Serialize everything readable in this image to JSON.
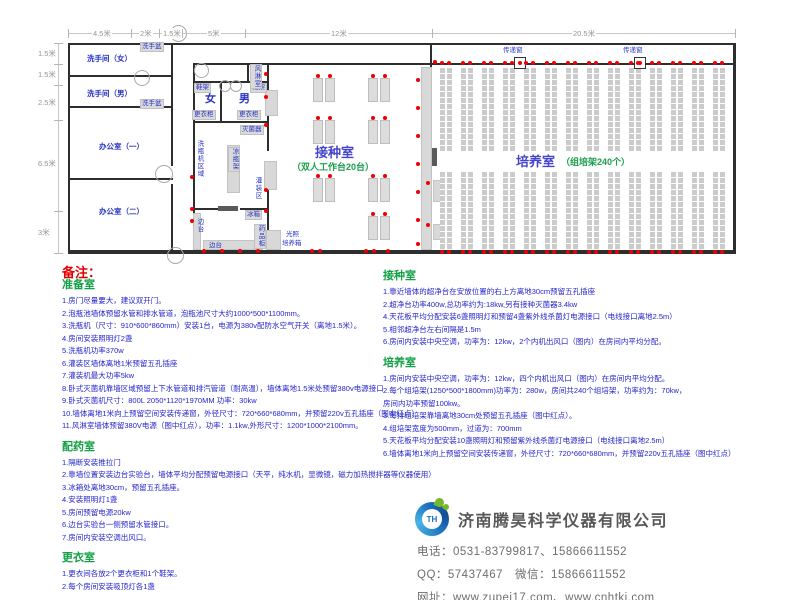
{
  "plan": {
    "dims_top": {
      "line_y": 33,
      "x1": 68,
      "x2": 735,
      "ticks": [
        68,
        131,
        159,
        182,
        245,
        432,
        735
      ],
      "labels": [
        {
          "t": "4.5米",
          "x": 92
        },
        {
          "t": "2米",
          "x": 139
        },
        {
          "t": "1.5米",
          "x": 162
        },
        {
          "t": "5米",
          "x": 207
        },
        {
          "t": "12米",
          "x": 330
        },
        {
          "t": "20.5米",
          "x": 572
        }
      ]
    },
    "dims_left": {
      "line_x": 58,
      "y1": 43,
      "y2": 253,
      "ticks": [
        43,
        64,
        85,
        120,
        211,
        253
      ],
      "labels": [
        {
          "t": "1.5米",
          "y": 48
        },
        {
          "t": "1.5米",
          "y": 69
        },
        {
          "t": "2.5米",
          "y": 97
        },
        {
          "t": "6.5米",
          "y": 158
        },
        {
          "t": "3米",
          "y": 227
        }
      ]
    },
    "walls": [
      [
        68,
        43,
        667,
        2
      ],
      [
        68,
        250,
        667,
        4
      ],
      [
        68,
        43,
        2,
        211
      ],
      [
        733,
        43,
        3,
        211
      ],
      [
        171,
        43,
        2,
        123
      ],
      [
        171,
        184,
        2,
        66
      ],
      [
        68,
        75,
        105,
        2
      ],
      [
        68,
        106,
        105,
        2
      ],
      [
        68,
        178,
        105,
        2
      ],
      [
        193,
        63,
        542,
        2
      ],
      [
        193,
        63,
        2,
        187
      ],
      [
        193,
        81,
        76,
        2
      ],
      [
        220,
        81,
        2,
        42
      ],
      [
        193,
        121,
        76,
        2
      ],
      [
        247,
        63,
        2,
        20
      ],
      [
        267,
        63,
        2,
        88
      ],
      [
        267,
        161,
        2,
        89
      ],
      [
        193,
        208,
        28,
        2
      ],
      [
        240,
        208,
        29,
        2
      ],
      [
        430,
        43,
        2,
        209
      ]
    ],
    "gray_boxes": [
      [
        265,
        90,
        13,
        26
      ],
      [
        227,
        145,
        13,
        48
      ],
      [
        264,
        161,
        13,
        29
      ],
      [
        266,
        230,
        15,
        20
      ],
      [
        193,
        213,
        8,
        37
      ],
      [
        203,
        240,
        60,
        10
      ],
      [
        421,
        67,
        11,
        183
      ],
      [
        433,
        180,
        9,
        22
      ],
      [
        433,
        224,
        9,
        16
      ]
    ],
    "dark_boxes": [
      [
        218,
        206,
        20,
        5
      ],
      [
        432,
        148,
        5,
        18
      ]
    ],
    "arcs": [
      {
        "x": 170,
        "y": 25,
        "d": 17
      },
      {
        "x": 134,
        "y": 70,
        "d": 16
      },
      {
        "x": 155,
        "y": 165,
        "d": 18
      },
      {
        "x": 167,
        "y": 247,
        "d": 17
      },
      {
        "x": 194,
        "y": 63,
        "d": 15
      },
      {
        "x": 219,
        "y": 80,
        "d": 12
      },
      {
        "x": 230,
        "y": 80,
        "d": 12
      }
    ],
    "room_labels": [
      {
        "t": "洗手间（女）",
        "x": 87,
        "y": 53
      },
      {
        "t": "洗手间（男）",
        "x": 87,
        "y": 88
      },
      {
        "t": "办公室（一）",
        "x": 99,
        "y": 141
      },
      {
        "t": "办公室（二）",
        "x": 99,
        "y": 206
      },
      {
        "t": "女",
        "x": 205,
        "y": 90,
        "big": true
      },
      {
        "t": "男",
        "x": 239,
        "y": 90,
        "big": true
      }
    ],
    "big_labels": [
      {
        "t": "接种室",
        "x": 315,
        "y": 142
      },
      {
        "t": "培养室",
        "x": 516,
        "y": 151
      }
    ],
    "paren_labels": [
      {
        "t": "（双人工作台20台）",
        "x": 292,
        "y": 160
      },
      {
        "t": "（组培架240个）",
        "x": 561,
        "y": 155
      }
    ],
    "boxed_labels": [
      {
        "t": "洗手盆",
        "x": 140,
        "y": 42
      },
      {
        "t": "洗手盆",
        "x": 140,
        "y": 99
      },
      {
        "t": "鞋架",
        "x": 194,
        "y": 83
      },
      {
        "t": "鞋架",
        "x": 250,
        "y": 83
      },
      {
        "t": "更衣柜",
        "x": 192,
        "y": 110
      },
      {
        "t": "更衣柜",
        "x": 237,
        "y": 110
      },
      {
        "t": "灭菌器",
        "x": 240,
        "y": 125
      },
      {
        "t": "冰箱",
        "x": 245,
        "y": 210
      },
      {
        "t": "药品柜",
        "x": 254,
        "y": 224,
        "vert": true
      },
      {
        "t": "凉瓶架",
        "x": 228,
        "y": 147,
        "vert": true
      },
      {
        "t": "风淋室",
        "x": 250,
        "y": 64,
        "vert": true
      }
    ],
    "plain_labels": [
      {
        "t": "洗瓶机区域",
        "x": 195,
        "y": 140,
        "vert": true
      },
      {
        "t": "灌装区",
        "x": 253,
        "y": 177,
        "vert": true
      },
      {
        "t": "边台",
        "x": 195,
        "y": 218,
        "vert": true
      },
      {
        "t": "边台",
        "x": 209,
        "y": 242
      },
      {
        "t": "光照",
        "x": 286,
        "y": 231
      },
      {
        "t": "培养箱",
        "x": 282,
        "y": 240
      },
      {
        "t": "传递窗",
        "x": 503,
        "y": 47
      },
      {
        "t": "传递窗",
        "x": 623,
        "y": 47
      }
    ],
    "benches": [
      [
        313,
        78
      ],
      [
        368,
        78
      ],
      [
        313,
        120
      ],
      [
        368,
        120
      ],
      [
        313,
        178
      ],
      [
        368,
        178
      ],
      [
        368,
        216
      ]
    ],
    "shelf": {
      "xs": [
        440,
        461,
        482,
        503,
        524,
        545,
        566,
        587,
        608,
        629,
        650,
        671,
        692,
        713
      ],
      "w": 12,
      "bands": [
        [
          67,
          84
        ],
        [
          171,
          79
        ]
      ]
    },
    "pass_windows": [
      {
        "x": 514,
        "y": 57
      },
      {
        "x": 634,
        "y": 57
      }
    ],
    "red_dots": [
      [
        266,
        74
      ],
      [
        266,
        97
      ],
      [
        266,
        125
      ],
      [
        266,
        190
      ],
      [
        266,
        211
      ],
      [
        192,
        177
      ],
      [
        192,
        209
      ],
      [
        192,
        221
      ],
      [
        204,
        251
      ],
      [
        222,
        251
      ],
      [
        240,
        251
      ],
      [
        258,
        251
      ],
      [
        312,
        251
      ],
      [
        320,
        251
      ],
      [
        366,
        251
      ],
      [
        374,
        251
      ],
      [
        388,
        251
      ],
      [
        418,
        80
      ],
      [
        418,
        108
      ],
      [
        418,
        136
      ],
      [
        418,
        164
      ],
      [
        418,
        192
      ],
      [
        418,
        220
      ],
      [
        418,
        244
      ],
      [
        428,
        183
      ],
      [
        428,
        225
      ],
      [
        435,
        62
      ]
    ]
  },
  "notes": {
    "heading": "备注：",
    "columns": [
      {
        "x": 62,
        "y": 279,
        "sections": [
          {
            "title": "准备室",
            "items": [
              "1.房门尽量要大，建议双开门。",
              "2.泡瓶池墙体预留水管和排水管道，泡瓶池尺寸大约1000*500*1100mm。",
              "3.洗瓶机（尺寸：910*600*860mm）安装1台，电源为380v配防水空气开关（离地1.5米）。",
              "4.房间安装照明灯2盏",
              "5.洗瓶机功率370w",
              "6.灌装区墙体离地1米预留五孔插座",
              "7.灌装机最大功率5kw",
              "8.卧式灭菌机靠墙区域预留上下水管道和排汽管道（耐高温），墙体离地1.5米处预留380v电源接口",
              "9.卧式灭菌机尺寸：800L  2050*1120*1970MM  功率：30kw",
              "10.墙体离地1米向上预留空间安装传递窗，外径尺寸：720*660*680mm，并预留220v五孔插座（图中红点）",
              "11.风淋室墙体预留380V电源（图中红点），功率：1.1kw,外形尺寸：1200*1000*2100mm。"
            ]
          },
          {
            "title": "配药室",
            "items": [
              "1.隔断安装推拉门",
              "2.靠墙位置安装边台实验台，墙体平均分配预留电源接口（天平，纯水机，显微镜，磁力加热搅拌器等仪器使用）",
              "3.冰箱处离地30cm，预留五孔插座。",
              "4.安装照明灯1盏",
              "5.房间预留电源20kw",
              "6.边台实验台一侧预留水管接口。",
              "7.房间内安装空调出风口。"
            ]
          },
          {
            "title": "更衣室",
            "items": [
              "1.更衣间各放2个更衣柜和1个鞋架。",
              "2.每个房间安装吸顶灯各1盏"
            ]
          }
        ]
      },
      {
        "x": 383,
        "y": 270,
        "sections": [
          {
            "title": "接种室",
            "items": [
              "1.靠近墙体的超净台在安放位置的右上方离地30cm预留五孔插座",
              "2.超净台功率400w,总功率约为:18kw,另有接种灭菌器3.4kw",
              "4.天花板平均分配安装6盏照明灯和预留4盏紫外线杀菌灯电源接口（电线接口离地2.5m）",
              "5.相邻超净台左右间隔是1.5m",
              "6.房间内安装中央空调，功率为：12kw，2个内机出风口（图内）在房间内平均分配。"
            ]
          },
          {
            "title": "培养室",
            "items": [
              "1.房间内安装中央空调，功率为：12kw，四个内机出风口（图内）在房间内平均分配。",
              "2.每个组培架(1250*500*1800mm)功率为：280w，房间共240个组培架，功率约为：70kw，",
              "房间内功率预留100kw。",
              "3.每排组培架靠墙离地30cm处预留五孔插座（图中红点）。",
              "4.组培架宽度为500mm，过道为：700mm",
              "5.天花板平均分配安装10盏照明灯和预留紫外线杀菌灯电源接口（电线接口离地2.5m）",
              "6.墙体离地1米向上预留空间安装传递窗，外径尺寸：720*660*680mm，并预留220v五孔插座（图中红点）"
            ]
          }
        ]
      }
    ]
  },
  "company": {
    "logo_monogram": "TH",
    "name": "济南腾昊科学仪器有限公司",
    "phone_line": "电话：0531-83799817、15866611552",
    "qq_line": "QQ：57437467　微信：15866611552",
    "web_line": "网址：www.zupei17.com、www.cnhtkj.com"
  }
}
